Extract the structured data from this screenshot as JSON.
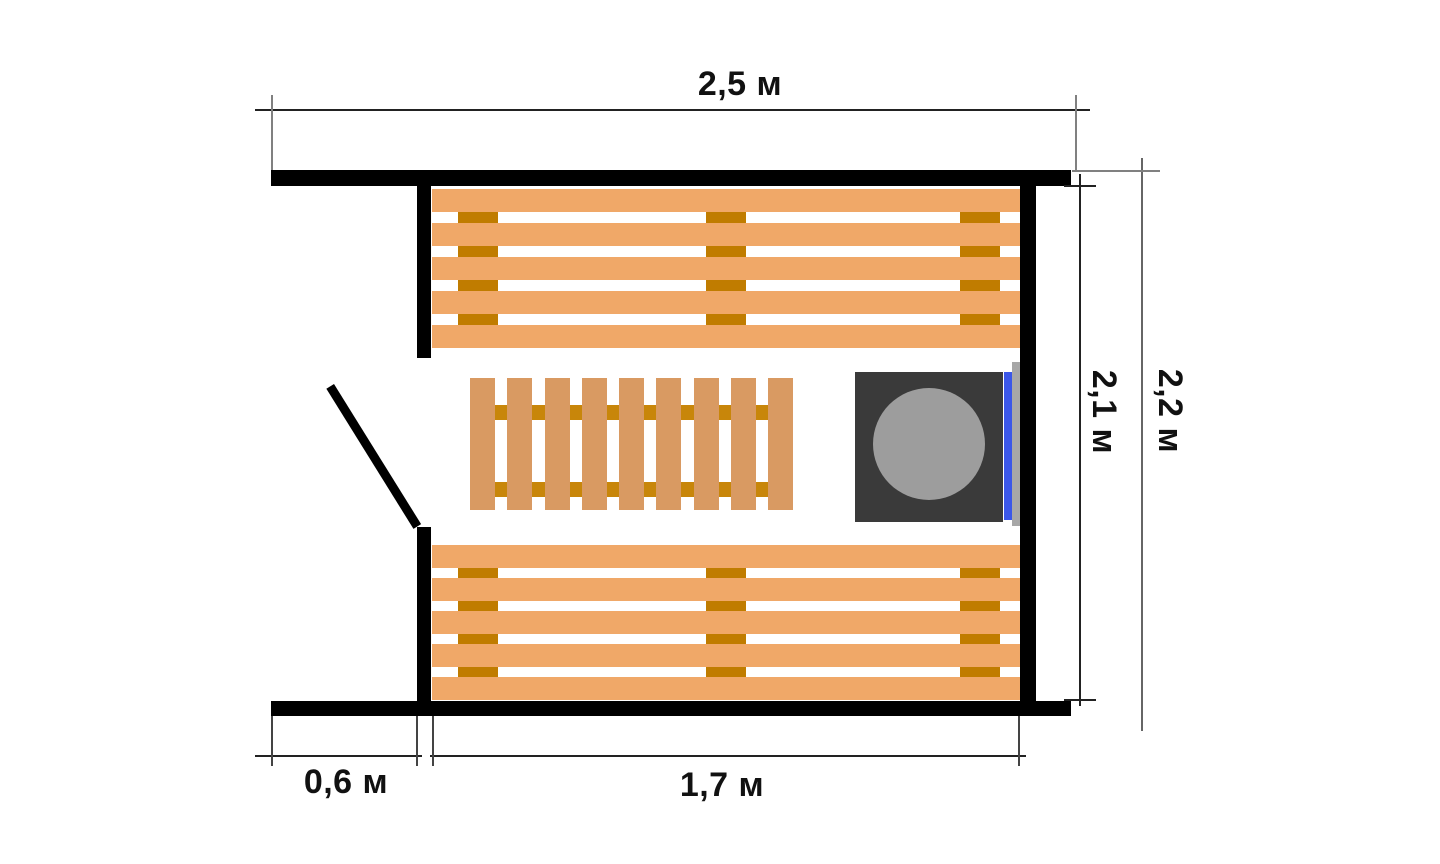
{
  "diagram": {
    "type": "floor-plan",
    "subject": "sauna steam room plan with benches, duckboard and stove",
    "labels": {
      "width_total": "2,5 м",
      "height_inner": "2,1 м",
      "height_total": "2,2 м",
      "entry_width": "0,6 м",
      "width_inner": "1,7 м"
    },
    "counts": {
      "bench_planks": 5,
      "bench_supports": 3,
      "duckboard_slats": 9,
      "duckboard_rails": 2
    },
    "colors": {
      "bench_plank": "#f0a868",
      "bench_support": "#c07c00",
      "duckboard_slat": "#d99a62",
      "duckboard_support": "#c8860a",
      "wall": "#000000",
      "stove_body": "#3a3a3a",
      "stove_stones": "#9d9d9d",
      "stove_accent_blue": "#3b57e9",
      "stove_grille": "#a7a7a7",
      "dim_line": "#222222",
      "ext_line": "#808080",
      "label_text": "#111111"
    }
  }
}
